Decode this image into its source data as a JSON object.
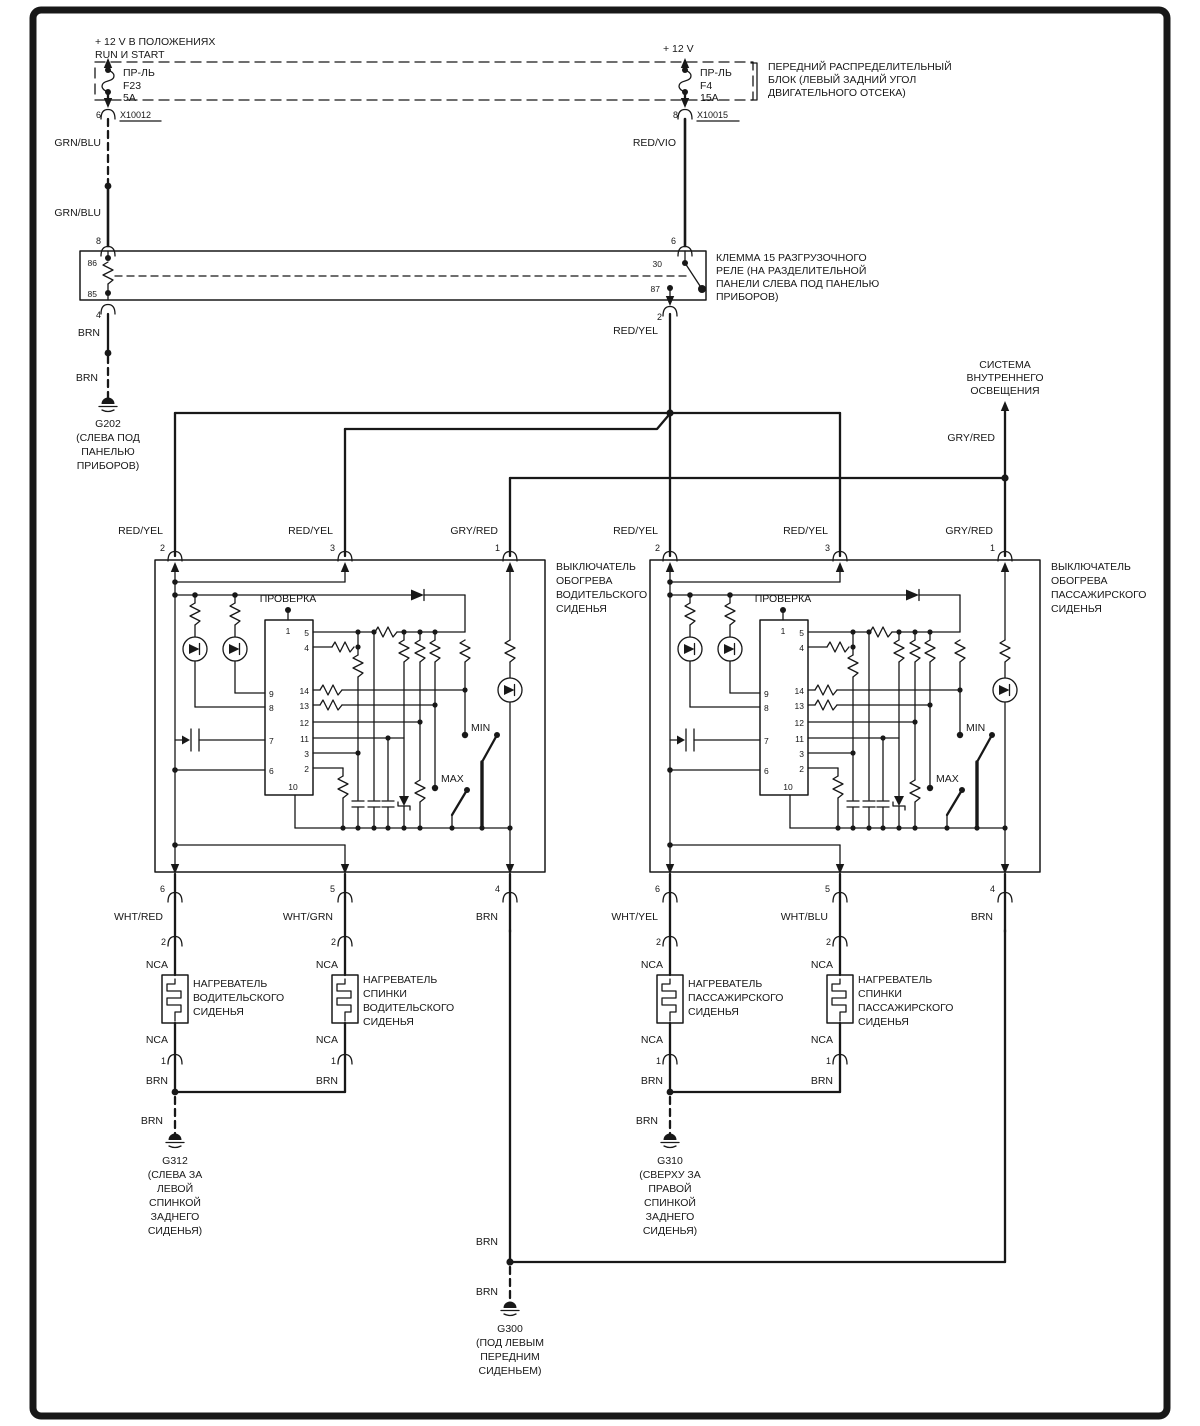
{
  "ink": "#181818",
  "power_left": {
    "line1": "+ 12 V  В ПОЛОЖЕНИЯХ",
    "line2": "RUN И START",
    "fuse_name": "ПР-ЛЬ",
    "fuse_id": "F23",
    "fuse_amp": "5A",
    "pin": "6",
    "connector": "X10012",
    "wire": "GRN/BLU",
    "wire2": "GRN/BLU",
    "relay_pin": "8"
  },
  "power_right": {
    "line1": "+ 12 V",
    "fuse_name": "ПР-ЛЬ",
    "fuse_id": "F4",
    "fuse_amp": "15A",
    "pin": "8",
    "connector": "X10015",
    "wire": "RED/VIO",
    "relay_pin": "6"
  },
  "dist_block": {
    "l1": "ПЕРЕДНИЙ РАСПРЕДЕЛИТЕЛЬНЫЙ",
    "l2": "БЛОК (ЛЕВЫЙ ЗАДНИЙ УГОЛ",
    "l3": "ДВИГАТЕЛЬНОГО ОТСЕКА)"
  },
  "relay": {
    "l1": "КЛЕММА 15 РАЗГРУЗОЧНОГО",
    "l2": "РЕЛЕ   (НА РАЗДЕЛИТЕЛЬНОЙ",
    "l3": "ПАНЕЛИ СЛЕВА ПОД ПАНЕЛЬЮ",
    "l4": "ПРИБОРОВ)",
    "pin86": "86",
    "pin85": "85",
    "pin30": "30",
    "pin87": "87",
    "pin_out_left": "4",
    "pin_out_right": "2",
    "out_wire": "RED/YEL"
  },
  "g202": {
    "wire1": "BRN",
    "wire2": "BRN",
    "id": "G202",
    "loc1": "(СЛЕВА ПОД",
    "loc2": "ПАНЕЛЬЮ",
    "loc3": "ПРИБОРОВ)"
  },
  "lighting": {
    "l1": "СИСТЕМА",
    "l2": "ВНУТРЕННЕГО",
    "l3": "ОСВЕЩЕНИЯ",
    "wire": "GRY/RED"
  },
  "switch": {
    "test": "ПРОВЕРКА",
    "min": "MIN",
    "max": "MAX",
    "top_pins": [
      {
        "n": "2",
        "wire": "RED/YEL"
      },
      {
        "n": "3",
        "wire": "RED/YEL"
      },
      {
        "n": "1",
        "wire": "GRY/RED"
      }
    ],
    "bottom_pins": [
      {
        "n": "6"
      },
      {
        "n": "5"
      },
      {
        "n": "4",
        "wire": "BRN"
      }
    ],
    "ic": {
      "top": "1",
      "left": [
        "9",
        "8",
        "7",
        "6"
      ],
      "right": [
        "5",
        "4",
        "14",
        "13",
        "12",
        "11",
        "3",
        "2"
      ],
      "bottom": "10"
    }
  },
  "switch_left_caption": [
    "ВЫКЛЮЧАТЕЛЬ",
    "ОБОГРЕВА",
    "ВОДИТЕЛЬСКОГО",
    "СИДЕНЬЯ"
  ],
  "switch_right_caption": [
    "ВЫКЛЮЧАТЕЛЬ",
    "ОБОГРЕВА",
    "ПАССАЖИРСКОГО",
    "СИДЕНЬЯ"
  ],
  "heater_common": {
    "pin_top": "2",
    "nca": "NCA",
    "pin_bottom": "1",
    "wire_bottom": "BRN"
  },
  "heater_wires": [
    "WHT/RED",
    "WHT/GRN",
    "WHT/YEL",
    "WHT/BLU"
  ],
  "heater_captions": [
    [
      "НАГРЕВАТЕЛЬ",
      "ВОДИТЕЛЬСКОГО",
      "СИДЕНЬЯ"
    ],
    [
      "НАГРЕВАТЕЛЬ",
      "СПИНКИ",
      "ВОДИТЕЛЬСКОГО",
      "СИДЕНЬЯ"
    ],
    [
      "НАГРЕВАТЕЛЬ",
      "ПАССАЖИРСКОГО",
      "СИДЕНЬЯ"
    ],
    [
      "НАГРЕВАТЕЛЬ",
      "СПИНКИ",
      "ПАССАЖИРСКОГО",
      "СИДЕНЬЯ"
    ]
  ],
  "g312": {
    "wire": "BRN",
    "id": "G312",
    "loc": [
      "(СЛЕВА ЗА",
      "ЛЕВОЙ",
      "СПИНКОЙ",
      "ЗАДНЕГО",
      "СИДЕНЬЯ)"
    ]
  },
  "g310": {
    "wire": "BRN",
    "id": "G310",
    "loc": [
      "(СВЕРХУ ЗА",
      "ПРАВОЙ",
      "СПИНКОЙ",
      "ЗАДНЕГО",
      "СИДЕНЬЯ)"
    ]
  },
  "g300": {
    "wire1": "BRN",
    "wire2": "BRN",
    "id": "G300",
    "loc": [
      "(ПОД ЛЕВЫМ",
      "ПЕРЕДНИМ",
      "СИДЕНЬЕМ)"
    ]
  }
}
